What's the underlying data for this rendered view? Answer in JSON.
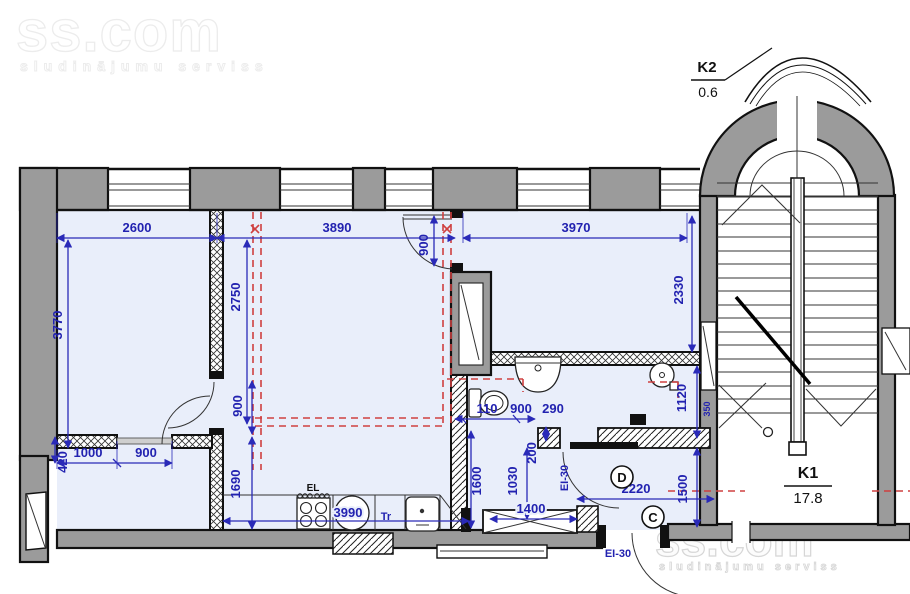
{
  "watermark": {
    "brand": "ss.com",
    "tagline": "sludinājumu serviss"
  },
  "rooms": {
    "k1": {
      "label": "K1",
      "area": "17.8"
    },
    "k2": {
      "label": "K2",
      "area": "0.6"
    }
  },
  "door_tags": {
    "c": "C",
    "d": "D"
  },
  "fire_ratings": {
    "hall_door": "EI-30",
    "exit_door": "EI-30"
  },
  "equipment": {
    "stove": "EL",
    "transformer": "Tr"
  },
  "dimensions_mm": {
    "room1_width": "2600",
    "living_width": "3890",
    "door_top": "900",
    "room2_width": "3970",
    "room1_depth": "3770",
    "partition_depth": "2750",
    "room2_depth": "2330",
    "wc_right_depth": "1120",
    "wc_seg1": "110",
    "wc_seg2": "900",
    "wc_seg3": "290",
    "wall_step": "420",
    "closet_w1": "1000",
    "closet_w2": "900",
    "door_left": "900",
    "hall_left_depth": "1690",
    "kitchen_width": "3990",
    "kitchen_depth": "1600",
    "gap": "200",
    "duct_depth": "1030",
    "window_width": "1400",
    "hall_width": "2220",
    "hall_depth": "1500",
    "stair_window": "350"
  },
  "colors": {
    "dimension_blue": "#2a2ab8",
    "demolition_red": "#cf4040",
    "wall_gray": "#9b9b9b",
    "room_fill": "#e9eefa"
  }
}
